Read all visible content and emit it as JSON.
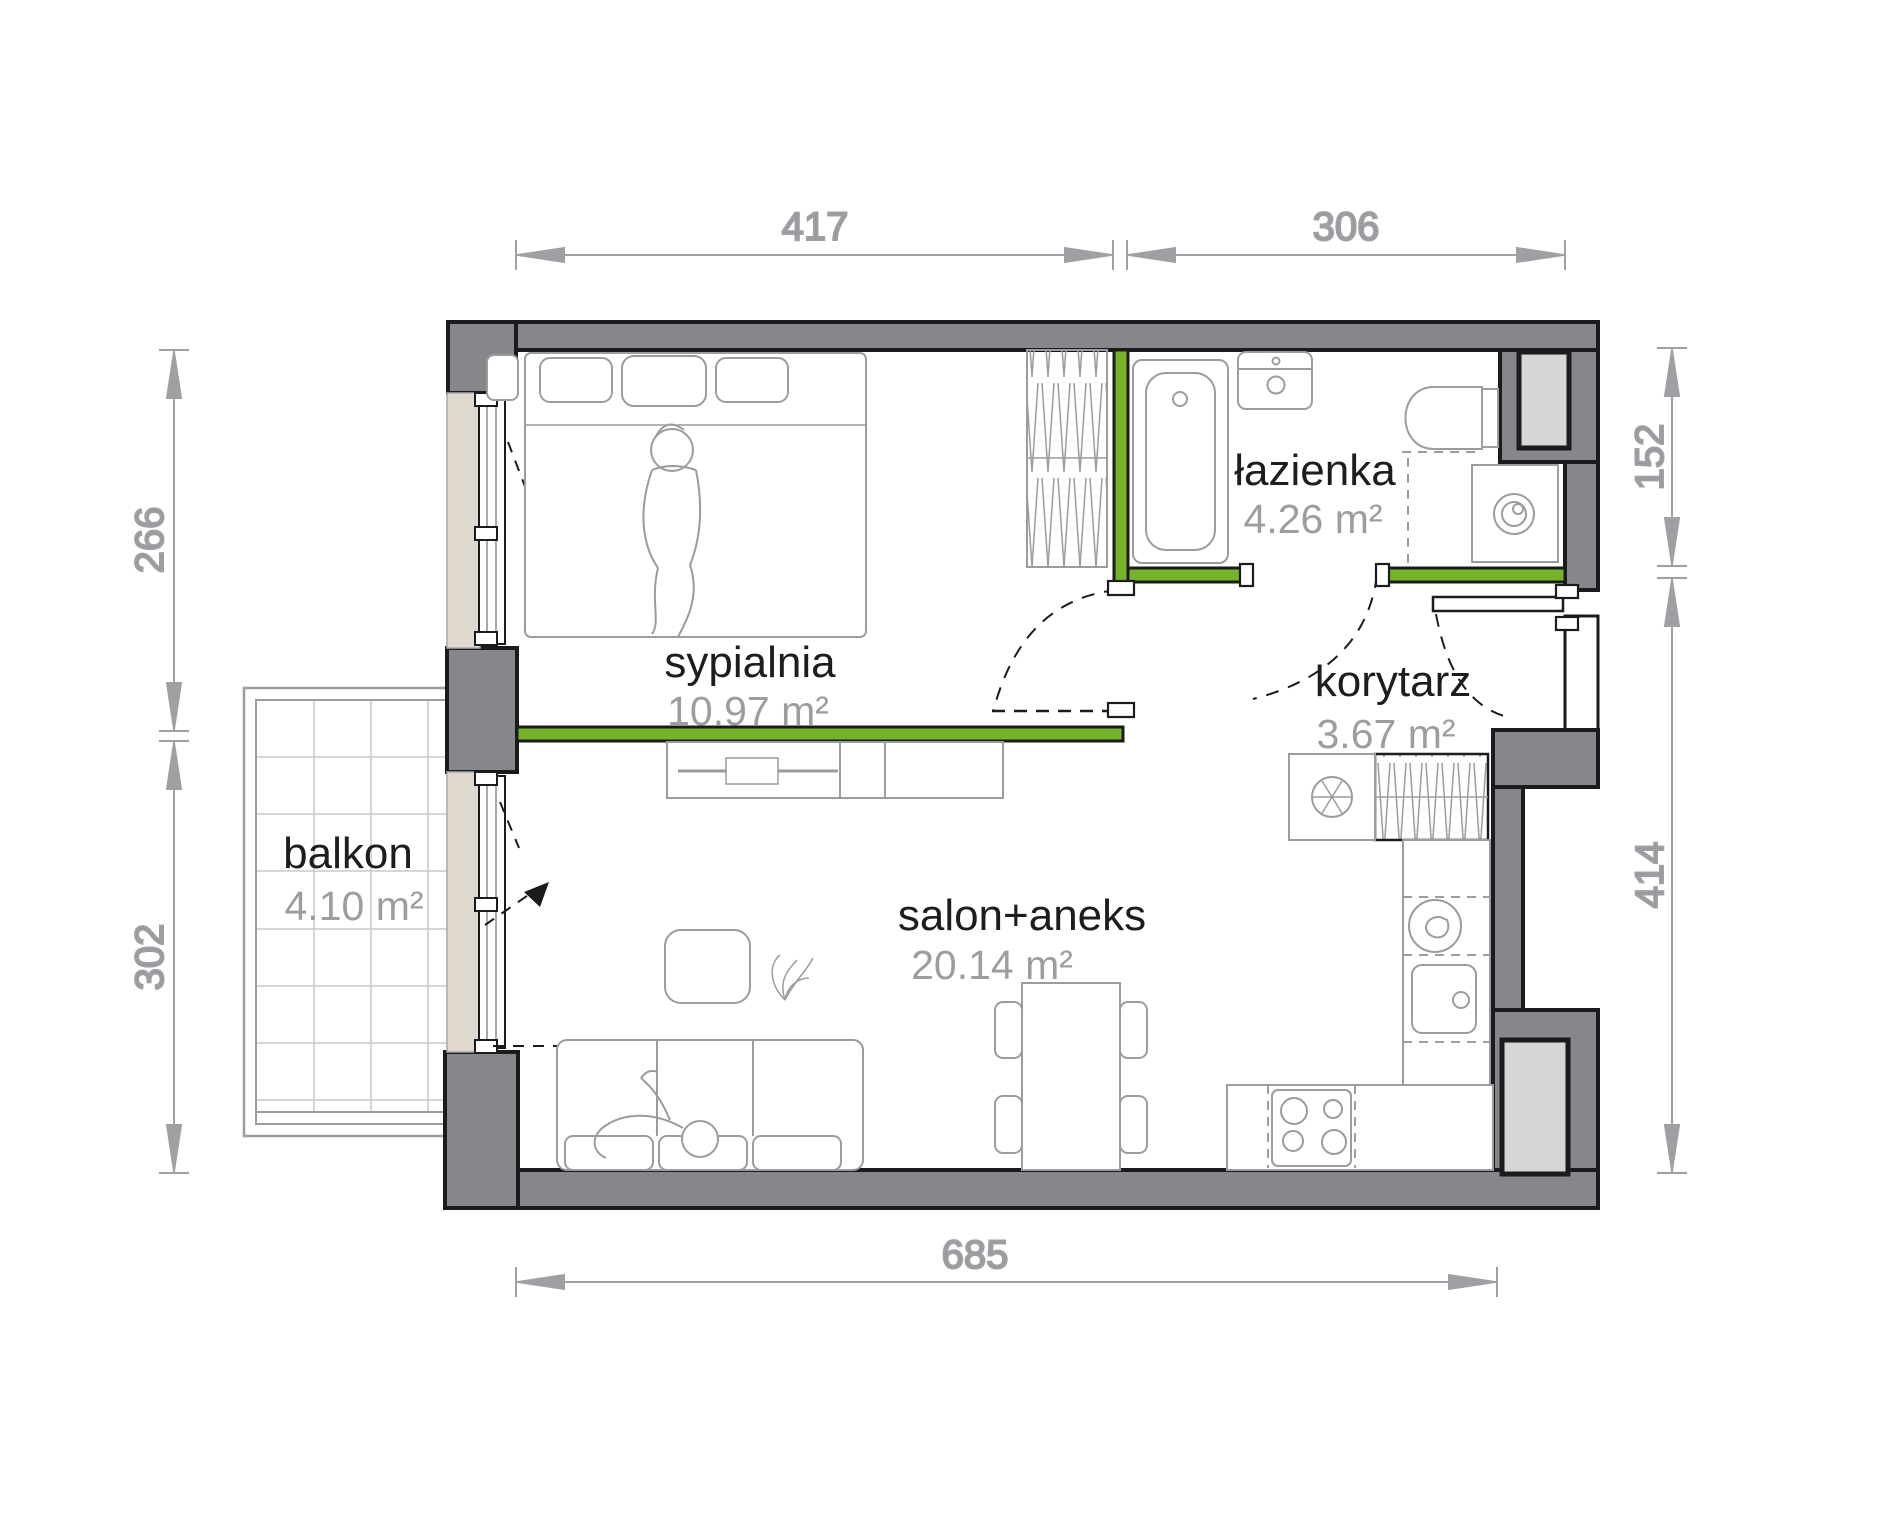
{
  "plan": {
    "rooms": [
      {
        "name": "sypialnia",
        "area": "10.97 m²"
      },
      {
        "name": "łazienka",
        "area": "4.26 m²"
      },
      {
        "name": "korytarz",
        "area": "3.67 m²"
      },
      {
        "name": "salon+aneks",
        "area": "20.14 m²"
      },
      {
        "name": "balkon",
        "area": "4.10 m²"
      }
    ],
    "dimensions_cm": {
      "top": [
        "417",
        "306"
      ],
      "left": [
        "266",
        "302"
      ],
      "right": [
        "152",
        "414"
      ],
      "bottom": [
        "685"
      ]
    },
    "colors": {
      "wall_fill": "#85878a",
      "outline": "#1b1b1d",
      "accent_green": "#76b32a",
      "window_beige": "#ded8cf",
      "shaft_fill": "#d5d6d7",
      "furniture_gray": "#9a9c9e",
      "dimension_gray": "#9ea0a3"
    }
  }
}
